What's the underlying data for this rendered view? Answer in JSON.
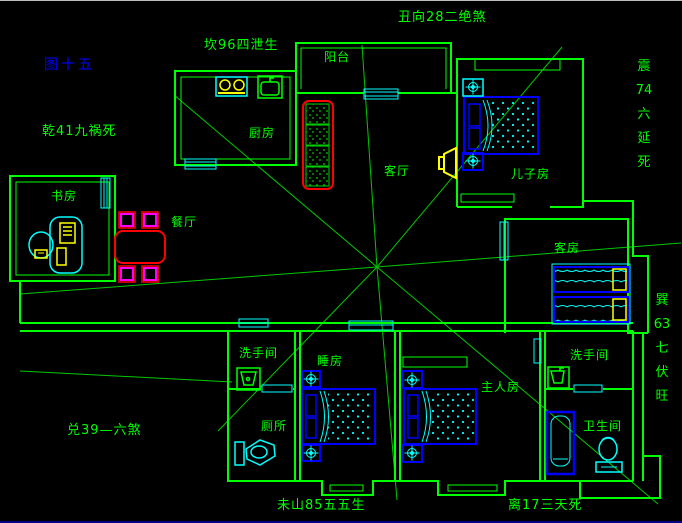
{
  "canvas": {
    "width": 682,
    "height": 522,
    "background": "#000000"
  },
  "title": {
    "text": "图十五",
    "color": "#0000ff"
  },
  "feng_shui_labels": {
    "top_direction": "丑向28二绝煞",
    "north": "坎96四泄生",
    "northwest": "乾41九祸死",
    "west": "兑39—六煞",
    "east_vertical": [
      "震",
      "74",
      "六",
      "延",
      "死"
    ],
    "southeast_vertical": [
      "巽",
      "63",
      "七",
      "伏",
      "旺"
    ],
    "bottom_mountain": "未山85五五生",
    "south": "离17三天死"
  },
  "rooms": {
    "balcony": "阳台",
    "kitchen": "厨房",
    "study": "书房",
    "dining": "餐厅",
    "living": "客厅",
    "son_room": "儿子房",
    "guest_room": "客房",
    "washroom_left": "洗手间",
    "toilet": "厕所",
    "bedroom": "睡房",
    "master_room": "主人房",
    "washroom_right": "洗手间",
    "bathroom": "卫生间"
  },
  "colors": {
    "wall_green": "#00ff00",
    "analysis_line_green": "#00c800",
    "window_cyan": "#00ffff",
    "furniture_blue": "#0000ff",
    "sofa_red": "#ff0000",
    "chair_magenta": "#ff00ff",
    "device_yellow": "#ffff00",
    "label_green": "#00ff00",
    "title_blue": "#0000ff",
    "background_black": "#000000"
  }
}
